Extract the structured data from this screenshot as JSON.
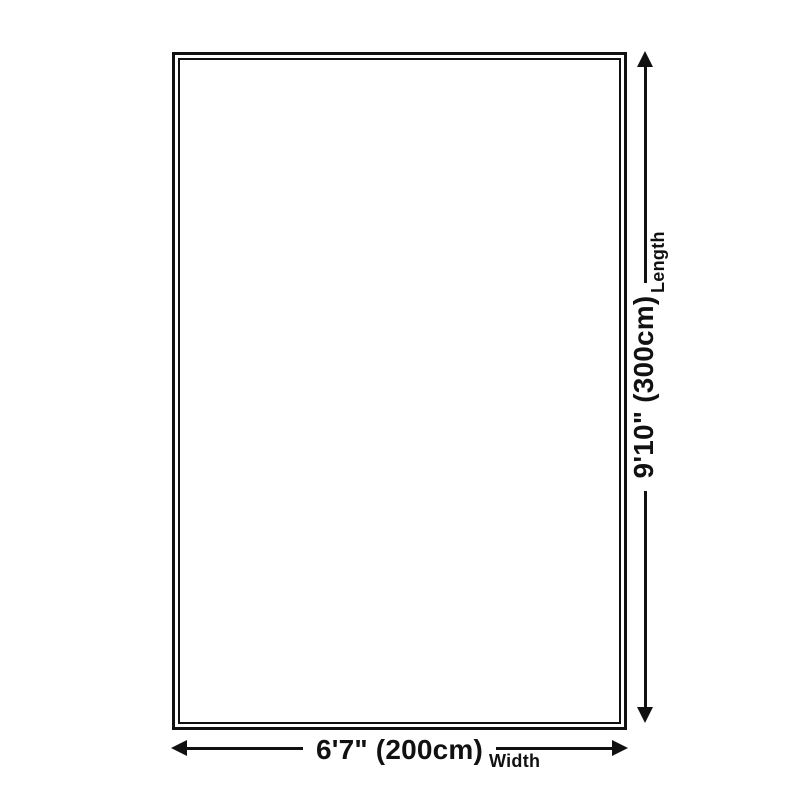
{
  "theme": {
    "ink": "#111111",
    "background": "#ffffff"
  },
  "diagram": {
    "type": "product-size-diagram",
    "shape": "rectangle"
  },
  "dimensions": {
    "width": {
      "value": "6'7\" (200cm)",
      "label": "Width"
    },
    "length": {
      "value": "9'10\" (300cm)",
      "label": "Length"
    }
  }
}
